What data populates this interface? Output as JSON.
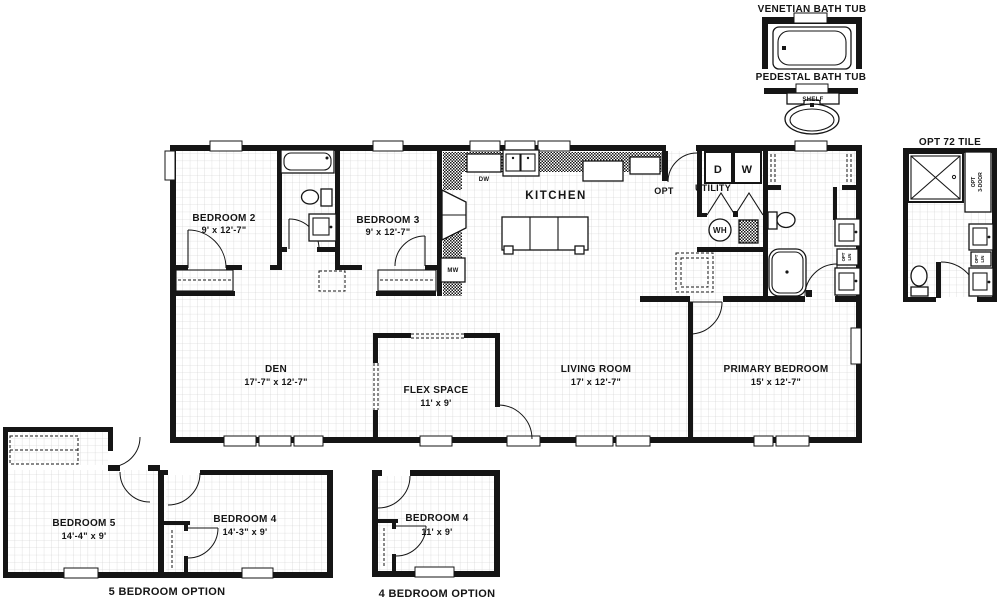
{
  "colors": {
    "ink": "#151515",
    "grid": "#cccccc",
    "background": "#ffffff"
  },
  "legend": {
    "venetian": "VENETIAN BATH TUB",
    "pedestal": "PEDESTAL BATH TUB",
    "shelf": "SHELF",
    "opt_tile": "OPT 72 TILE",
    "opt_3door_1": "OPT",
    "opt_3door_2": "3-DOOR",
    "opt_lin_1": "OPT",
    "opt_lin_2": "LIN"
  },
  "rooms": {
    "bedroom2": {
      "name": "BEDROOM 2",
      "dims": "9' x 12'-7\""
    },
    "bedroom3": {
      "name": "BEDROOM 3",
      "dims": "9' x 12'-7\""
    },
    "kitchen": {
      "name": "KITCHEN"
    },
    "utility": {
      "name": "UTILITY"
    },
    "opt_door": "OPT",
    "den": {
      "name": "DEN",
      "dims": "17'-7\" x 12'-7\""
    },
    "flex": {
      "name": "FLEX SPACE",
      "dims": "11' x 9'"
    },
    "living": {
      "name": "LIVING ROOM",
      "dims": "17' x 12'-7\""
    },
    "primary": {
      "name": "PRIMARY BEDROOM",
      "dims": "15' x 12'-7\""
    }
  },
  "appliances": {
    "dryer": "D",
    "washer": "W",
    "water_heater": "WH",
    "dishwasher": "DW",
    "microwave": "MW"
  },
  "options": {
    "five_bedroom": {
      "caption": "5 BEDROOM OPTION",
      "bedroom5": {
        "name": "BEDROOM 5",
        "dims": "14'-4\" x 9'"
      },
      "bedroom4": {
        "name": "BEDROOM 4",
        "dims": "14'-3\" x 9'"
      }
    },
    "four_bedroom": {
      "caption": "4 BEDROOM OPTION",
      "bedroom4": {
        "name": "BEDROOM 4",
        "dims": "11' x 9'"
      }
    }
  }
}
